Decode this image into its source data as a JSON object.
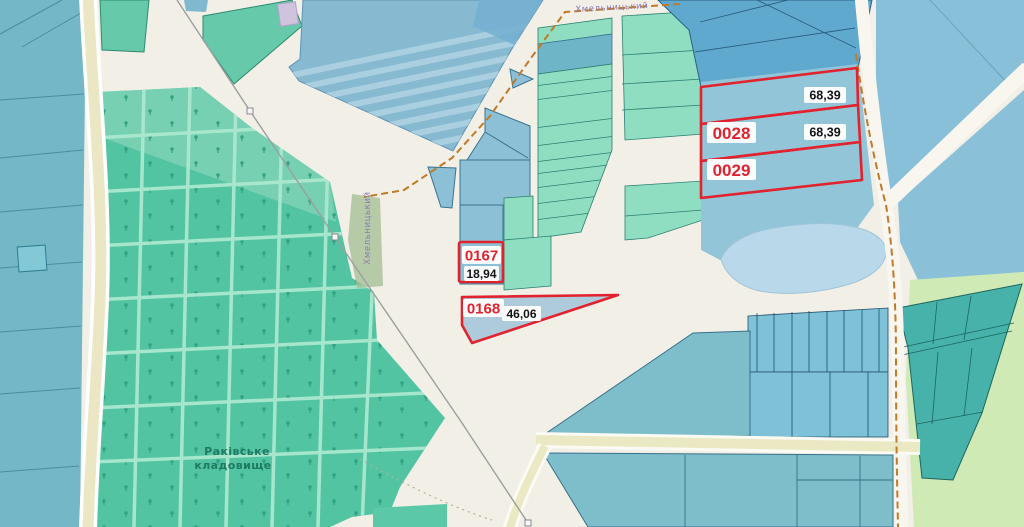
{
  "labels": {
    "cemetery_line1": "Раківське",
    "cemetery_line2": "кладовище",
    "street_top": "Хмельницький",
    "street_side": "Хмельницький"
  },
  "parcels": {
    "strip_north": {
      "area": "68,39"
    },
    "p0028": {
      "id": "0028",
      "area": "68,39"
    },
    "p0029": {
      "id": "0029"
    },
    "p0167": {
      "id": "0167",
      "area": "18,94"
    },
    "p0168": {
      "id": "0168",
      "area": "46,06"
    }
  },
  "colors": {
    "highlight_red": "#e2232e",
    "area_text": "#141414",
    "map_background": "#f2efe7",
    "pond_blue": "#b9d9ea",
    "cemetery_green": "#52c4a2",
    "mint_parcel": "#8fdec2",
    "blue_parcel": "#87c0d8",
    "farmland_green": "#cfeab4",
    "teal_parcel": "#47b2a9",
    "road_yellow": "#ebe8c4",
    "track_orange": "#c07a28",
    "street_label_purple": "#8a7ab8",
    "cemetery_label_green": "#1e7a62"
  }
}
